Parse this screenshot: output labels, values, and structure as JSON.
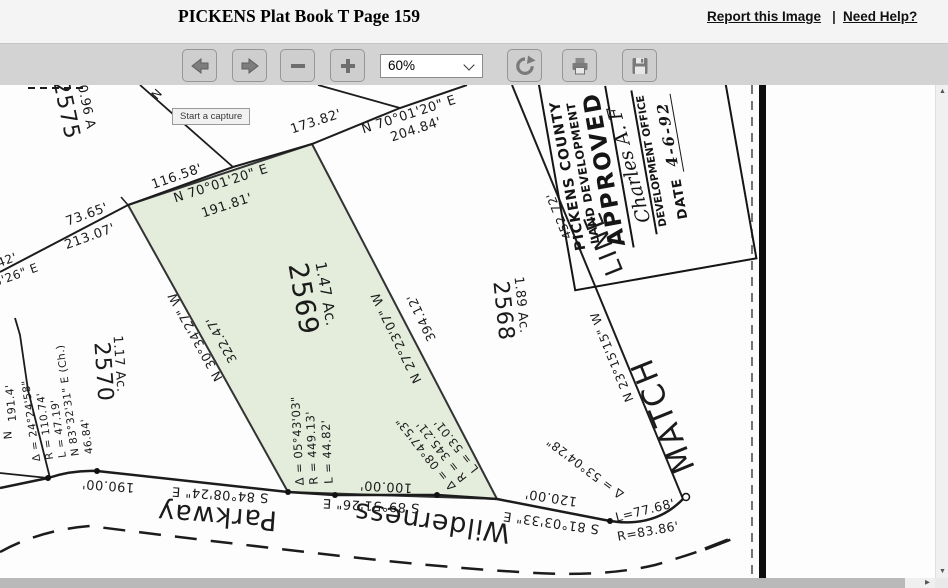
{
  "header": {
    "title": "PICKENS Plat Book T Page 159",
    "report_link": "Report this Image",
    "separator": "|",
    "help_link": "Need Help?"
  },
  "toolbar": {
    "zoom_value": "60%",
    "icons": {
      "back": "left-arrow",
      "forward": "right-arrow",
      "zoom_out": "minus",
      "zoom_in": "plus",
      "rotate": "rotate-clockwise-arrow",
      "print": "printer",
      "save": "floppy-disk"
    }
  },
  "tooltip": {
    "text": "Start a capture"
  },
  "scrollbar": {
    "up": "▲",
    "down": "▼",
    "right": "▶"
  },
  "map": {
    "highlight_color": "#e4ecdc",
    "boundary_texts": {
      "seg1_dist": "116.58'",
      "seg2_dist": "173.82'",
      "green_top_bearing": "N 70°01'20\" E",
      "green_top_dist": "191.81'",
      "seg3_bearing": "N 70°01'20\" E",
      "seg3_dist": "204.84'",
      "left1_dist": "73.65'",
      "left2_dist": "213.07'",
      "edge_frag_dist": "42'",
      "edge_frag_bearing": "5'26\" E",
      "green_left_bearing": "N 30°34'27\" W",
      "green_left_dist": "322.47'",
      "green_right_bearing": "N 27°23'07\" W",
      "green_right_dist": "394.12'",
      "match_bearing": "N 23°15'15\" W",
      "match_dist": "452.72'",
      "road_seg1_bearing": "S 84°08'24\" E",
      "road_seg1_dist": "190.00'",
      "road_seg2_bearing": "S 89°51'26\" E",
      "road_seg2_dist": "100.00'",
      "road_seg3_bearing": "S 81°03'33\" E",
      "road_seg3_dist": "120.00'",
      "road_curve_delta": "Δ = 53°04'28\"",
      "road_curve_len": "L=77.68'",
      "road_curve_radius": "R=83.86'",
      "frag_191": "191.4'",
      "frag_n": "N",
      "frag_n_top": "N"
    },
    "parcels": {
      "p2569": {
        "number": "2569",
        "area": "1.47 Ac."
      },
      "p2570": {
        "number": "2570",
        "area": "1.17 Ac."
      },
      "p2568": {
        "number": "2568",
        "area": "1.89 Ac."
      },
      "p2575": {
        "number": "2575",
        "area": "0.96 A"
      }
    },
    "curves": {
      "c1": {
        "delta": "Δ = 05°43'03\"",
        "radius": "R = 449.13'",
        "length": "L = 44.82'"
      },
      "c2": {
        "delta": "Δ = 08°47'53\"",
        "radius": "R = 345.21'",
        "length": "L = 53.01'"
      },
      "c3": {
        "delta": "Δ = 24°24'58\"",
        "radius": "R = 110.74'",
        "length": "L = 47.19'",
        "chord_bearing": "N 83°32'31\" E (Ch.)",
        "chord": "46.84'"
      }
    },
    "roads": {
      "name1": "Wilderness",
      "name2": "Parkway"
    },
    "match_line": {
      "word1": "MATCH",
      "word2": "LINE"
    },
    "stamp": {
      "line1": "PICKENS COUNTY",
      "line2": "LAND DEVELOPMENT",
      "approved": "APPROVED",
      "signature": "Charles A. F",
      "office": "DEVELOPMENT OFFICE",
      "date_label": "DATE",
      "date_value": "4-6-92"
    }
  }
}
